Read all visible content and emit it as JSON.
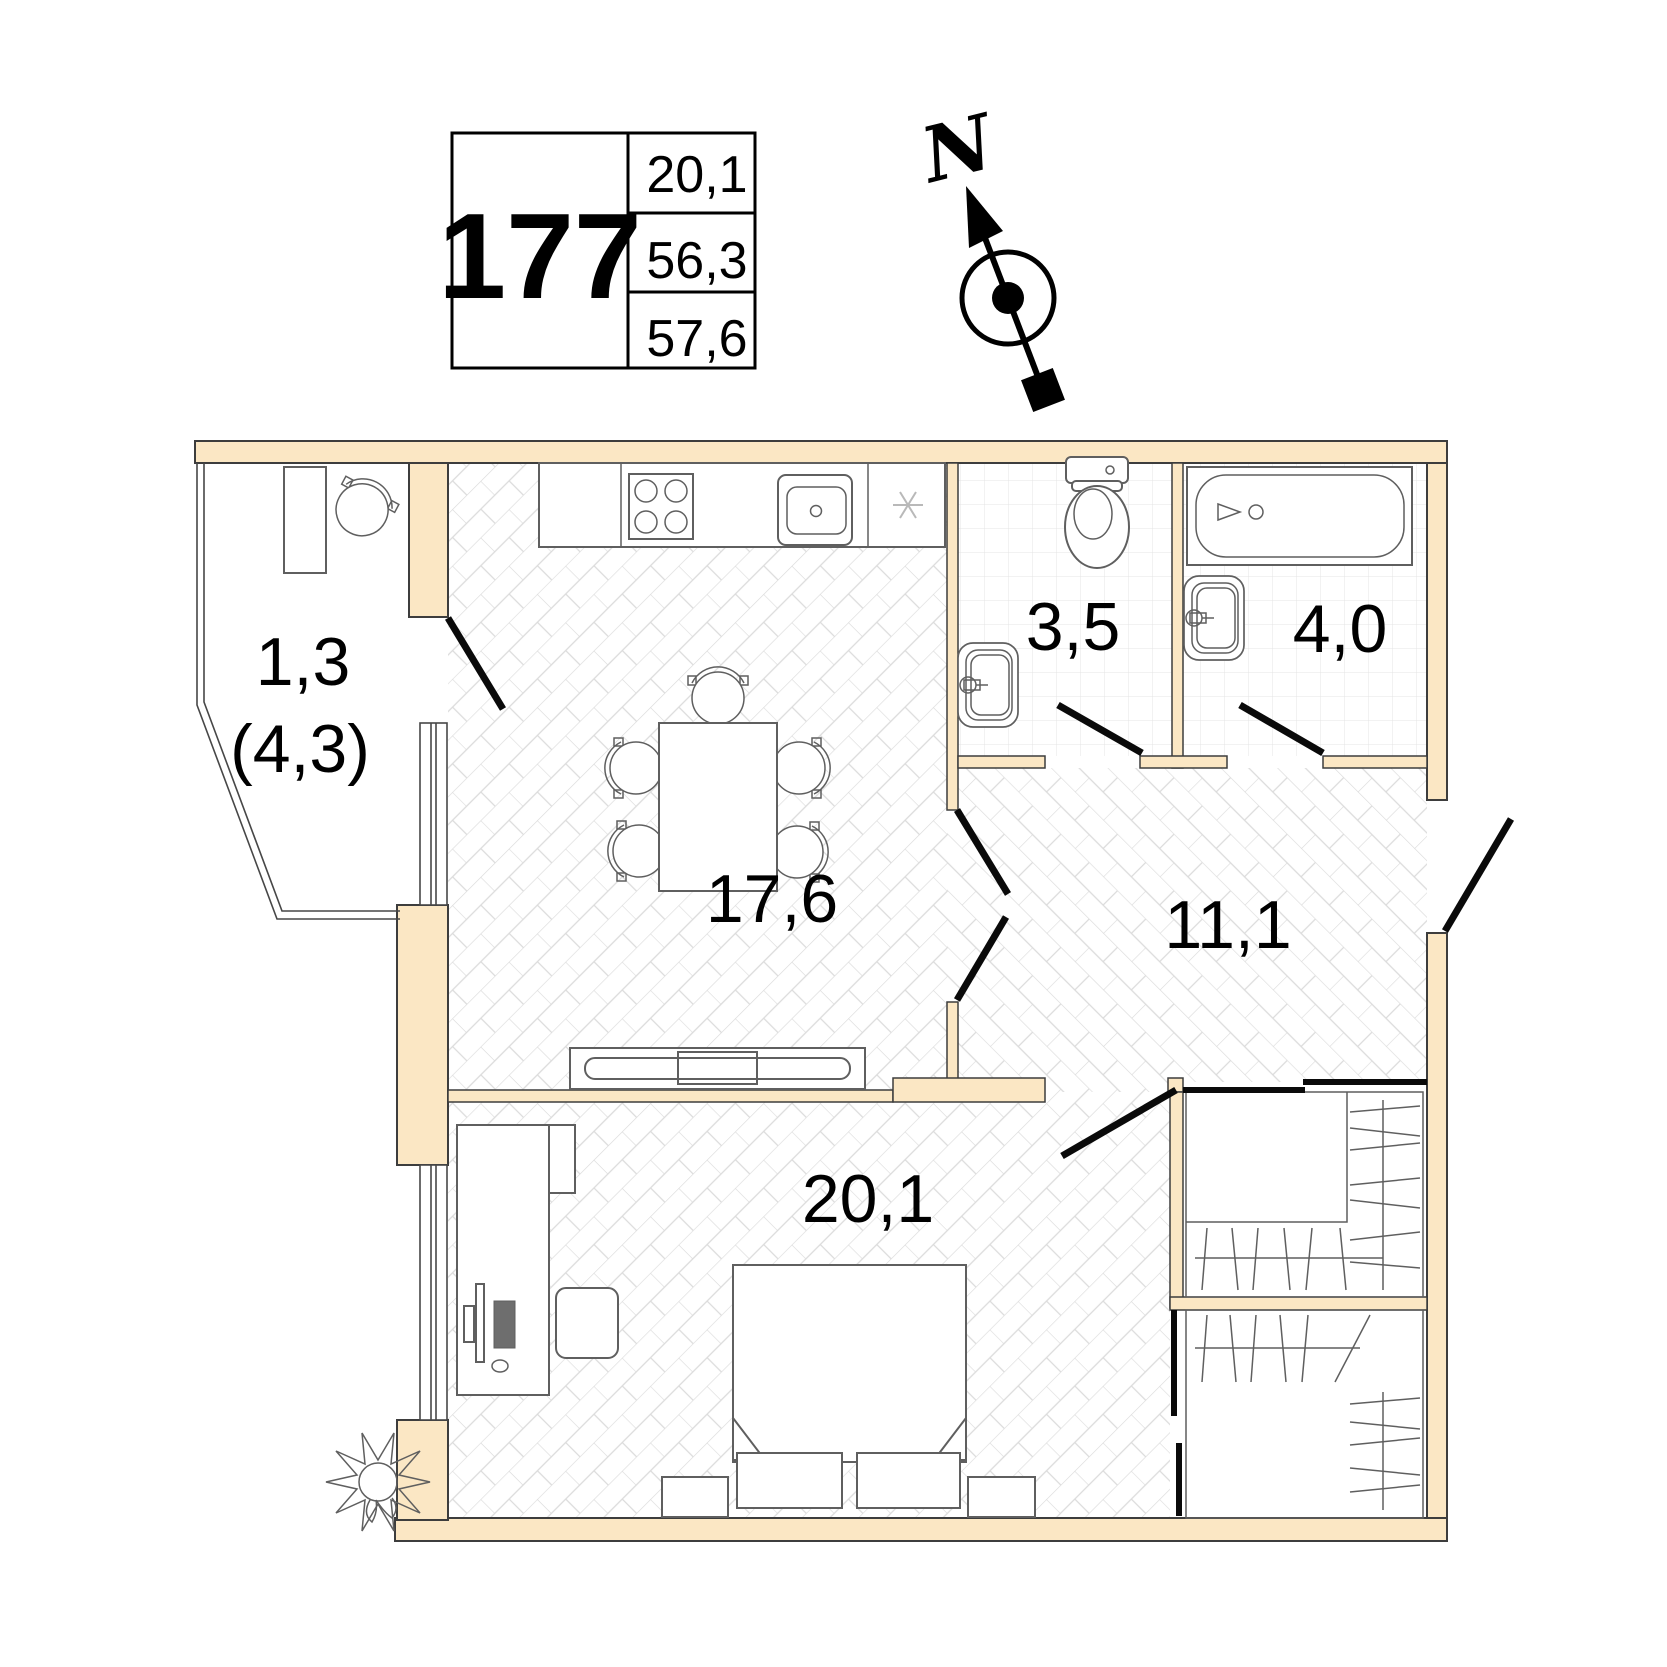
{
  "colors": {
    "wall_fill": "#FBE7C4",
    "wall_stroke": "#3D3D3D",
    "floor_line": "#DBDBDB",
    "tile_line": "#E4E4E4",
    "fixture_stroke": "#5F5F5F",
    "door_line": "#0A0A0A"
  },
  "info_card": {
    "unit_number": "177",
    "rows": [
      "20,1",
      "56,3",
      "57,6"
    ]
  },
  "compass": {
    "north_label": "N"
  },
  "rooms": {
    "balcony": {
      "area": "1,3",
      "area_total": "(4,3)"
    },
    "kitchen_living": {
      "area": "17,6"
    },
    "wc": {
      "area": "3,5"
    },
    "bathroom": {
      "area": "4,0"
    },
    "hallway": {
      "area": "11,1"
    },
    "bedroom": {
      "area": "20,1"
    }
  },
  "icons": {
    "kitchen_vent": "asterisk"
  }
}
